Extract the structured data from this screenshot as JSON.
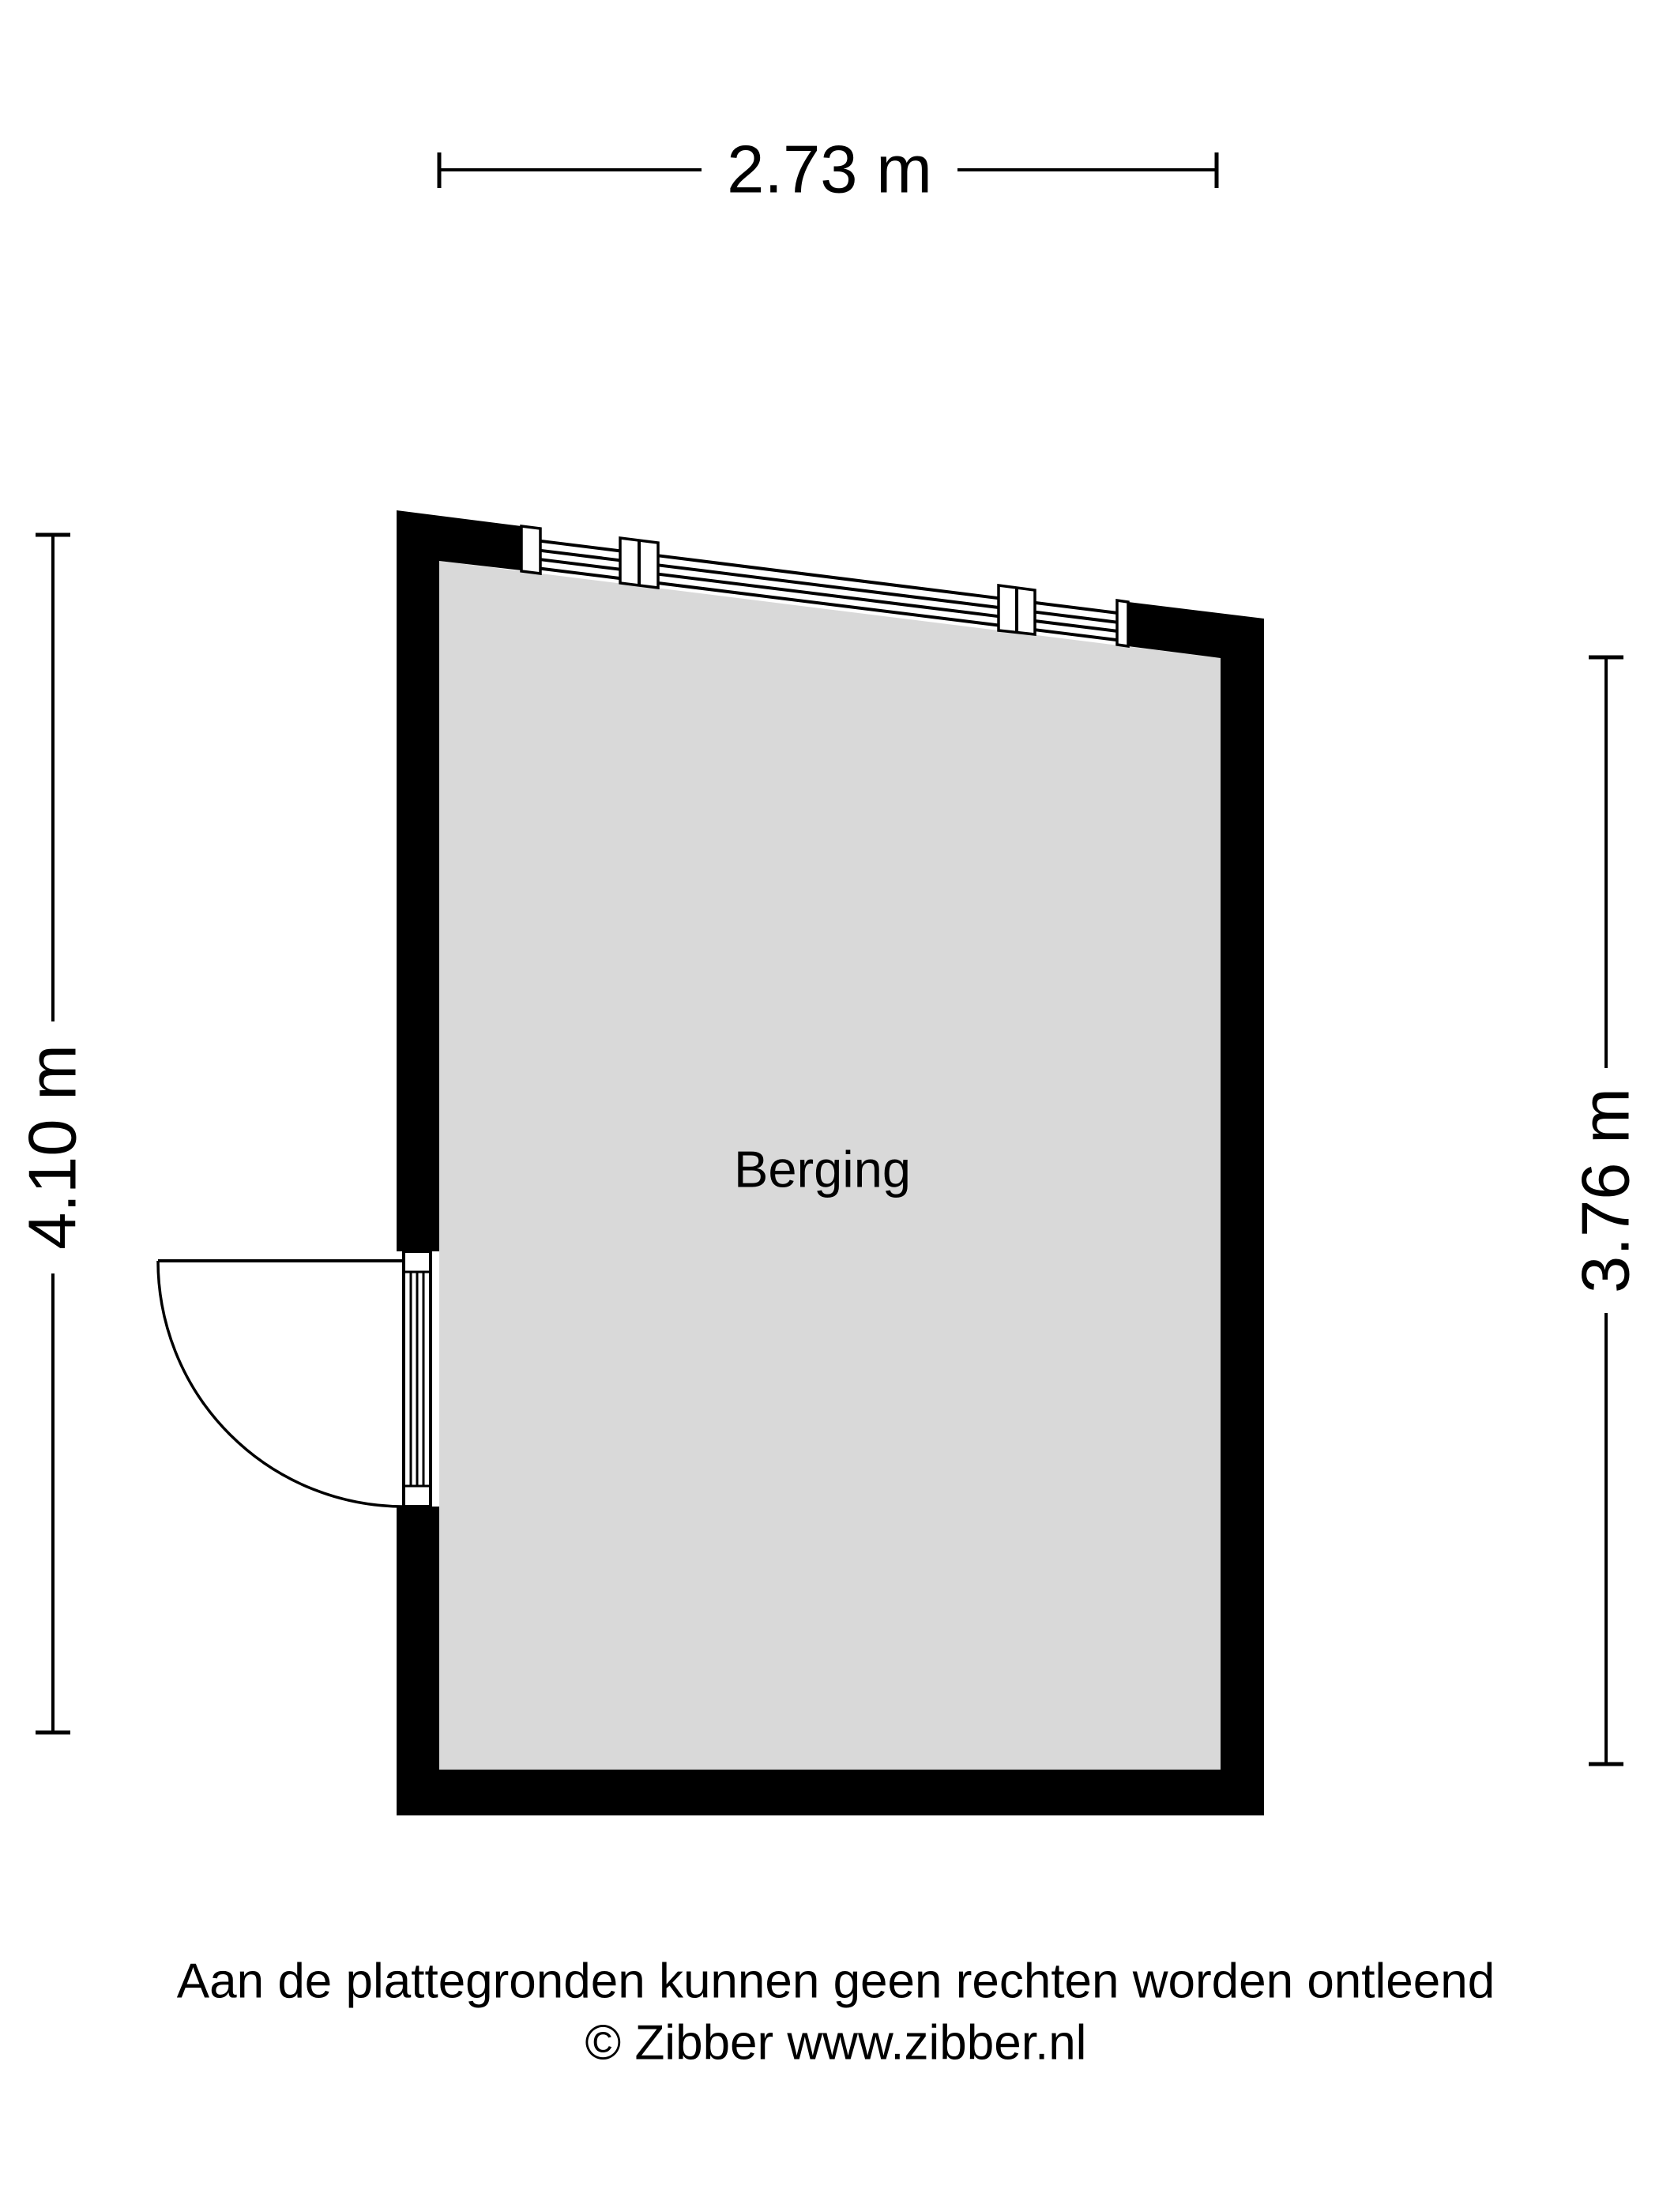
{
  "page": {
    "background": "#ffffff"
  },
  "colors": {
    "wall": "#000000",
    "floor": "#d9d9d9",
    "line": "#000000",
    "text": "#000000"
  },
  "dimensions": {
    "top_width": "2.73 m",
    "left_height": "4.10 m",
    "right_height": "3.76 m"
  },
  "room": {
    "label": "Berging"
  },
  "footer": {
    "disclaimer": "Aan de plattegronden kunnen geen rechten worden ontleend",
    "copyright": "© Zibber www.zibber.nl"
  }
}
